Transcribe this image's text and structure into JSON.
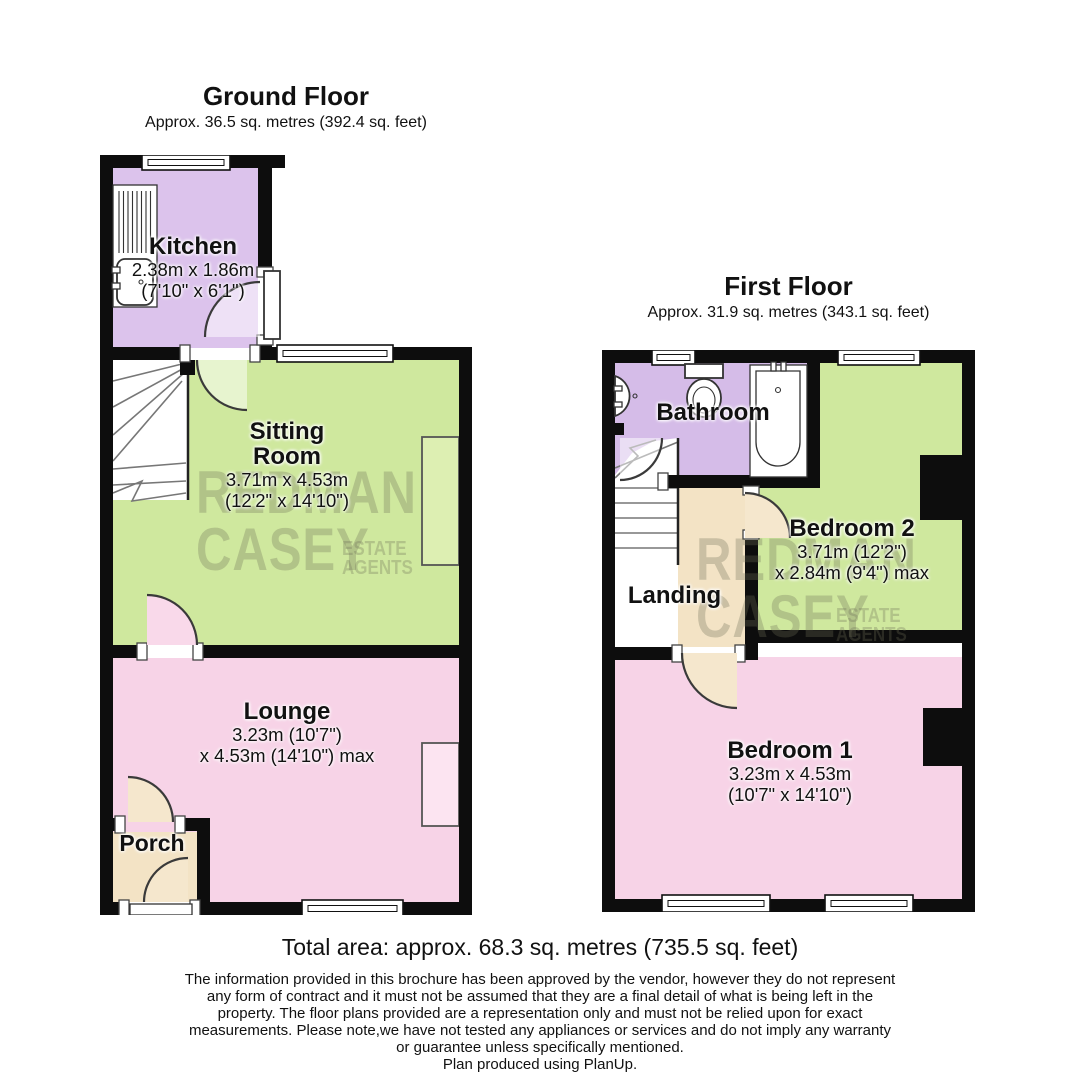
{
  "ground_floor": {
    "title": "Ground Floor",
    "subtitle": "Approx. 36.5 sq. metres (392.4 sq. feet)",
    "kitchen": {
      "name": "Kitchen",
      "dim_metric": "2.38m x 1.86m",
      "dim_imperial": "(7'10\" x 6'1\")"
    },
    "sitting_room": {
      "name_line1": "Sitting",
      "name_line2": "Room",
      "dim_metric": "3.71m x 4.53m",
      "dim_imperial": "(12'2\" x 14'10\")"
    },
    "lounge": {
      "name": "Lounge",
      "dim_metric": "3.23m (10'7\")",
      "dim_imperial": "x 4.53m (14'10\") max"
    },
    "porch": {
      "name": "Porch"
    }
  },
  "first_floor": {
    "title": "First Floor",
    "subtitle": "Approx. 31.9 sq. metres (343.1 sq. feet)",
    "bathroom": {
      "name": "Bathroom"
    },
    "bedroom2": {
      "name": "Bedroom 2",
      "dim_metric": "3.71m (12'2\")",
      "dim_imperial": "x 2.84m (9'4\") max"
    },
    "landing": {
      "name": "Landing"
    },
    "bedroom1": {
      "name": "Bedroom 1",
      "dim_metric": "3.23m x 4.53m",
      "dim_imperial": "(10'7\" x 14'10\")"
    }
  },
  "watermark": {
    "line1": "REDMAN",
    "line2": "CASEY",
    "tag_line1": "ESTATE",
    "tag_line2": "AGENTS"
  },
  "footer": {
    "total_area": "Total area: approx. 68.3 sq. metres (735.5 sq. feet)",
    "disclaimer_lines": [
      "The information provided in this brochure has been approved by the vendor, however they do not represent",
      "any form of contract and it must not be assumed that they are a final detail of what is being left in the",
      "property. The floor plans provided are a representation only and must not be relied upon for exact",
      "measurements. Please note,we have not tested any appliances or services and do not imply any warranty",
      "or guarantee unless specifically mentioned."
    ],
    "producer": "Plan produced using PlanUp."
  },
  "colors": {
    "wall": "#0d0d0d",
    "kitchen_purple": "#dcc3ec",
    "bathroom_purple": "#d5bce8",
    "living_green": "#cfe89e",
    "bedroom_pink": "#f7d3e7",
    "hall_cream": "#f3e3c5"
  }
}
